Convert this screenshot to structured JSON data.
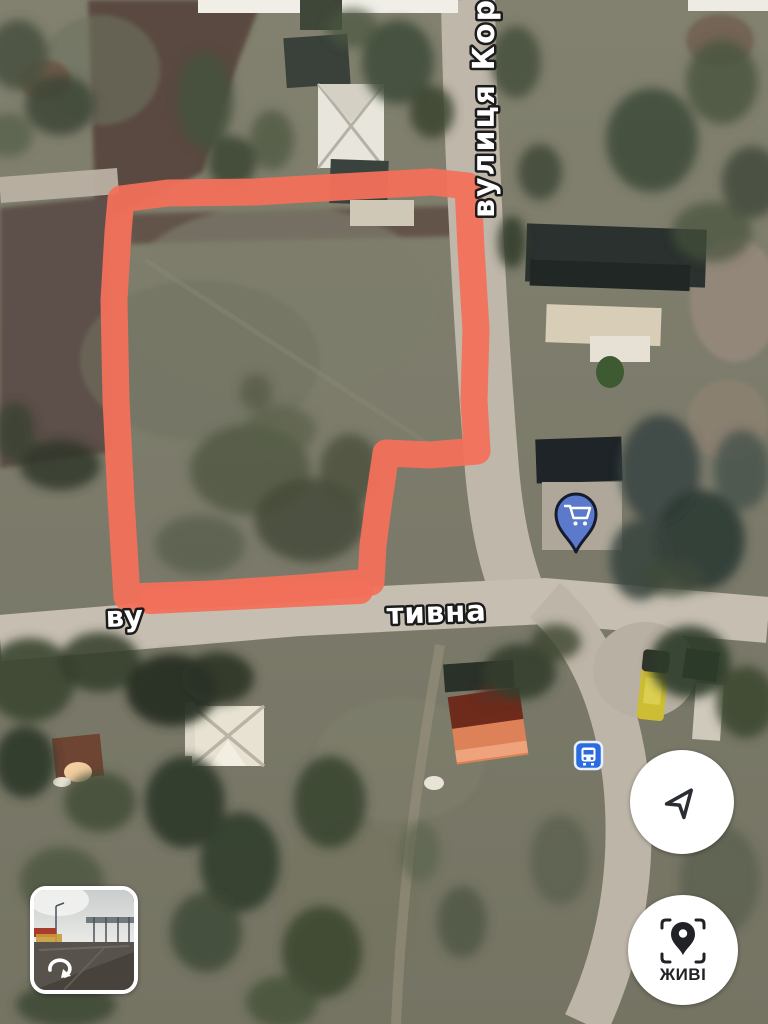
{
  "map": {
    "street_label_vertical": "вулиця Кор",
    "street_label_horizontal": {
      "prefix": "ву",
      "suffix": "тивна"
    },
    "plot_outline_color": "#F2705A",
    "markers": {
      "shopping_cart": {
        "icon": "shopping-cart-icon",
        "color": "#5C7ACB",
        "outline": "#161C2E"
      },
      "bus_stop": {
        "icon": "bus-icon",
        "color": "#2A6BE0"
      }
    }
  },
  "controls": {
    "navigation_button": {
      "icon": "navigation-arrow-icon"
    },
    "live_view_button": {
      "icon": "live-view-pin-scan-icon",
      "label": "ЖИВІ"
    },
    "street_view_preview": {
      "icon": "rotate-360-icon"
    }
  }
}
